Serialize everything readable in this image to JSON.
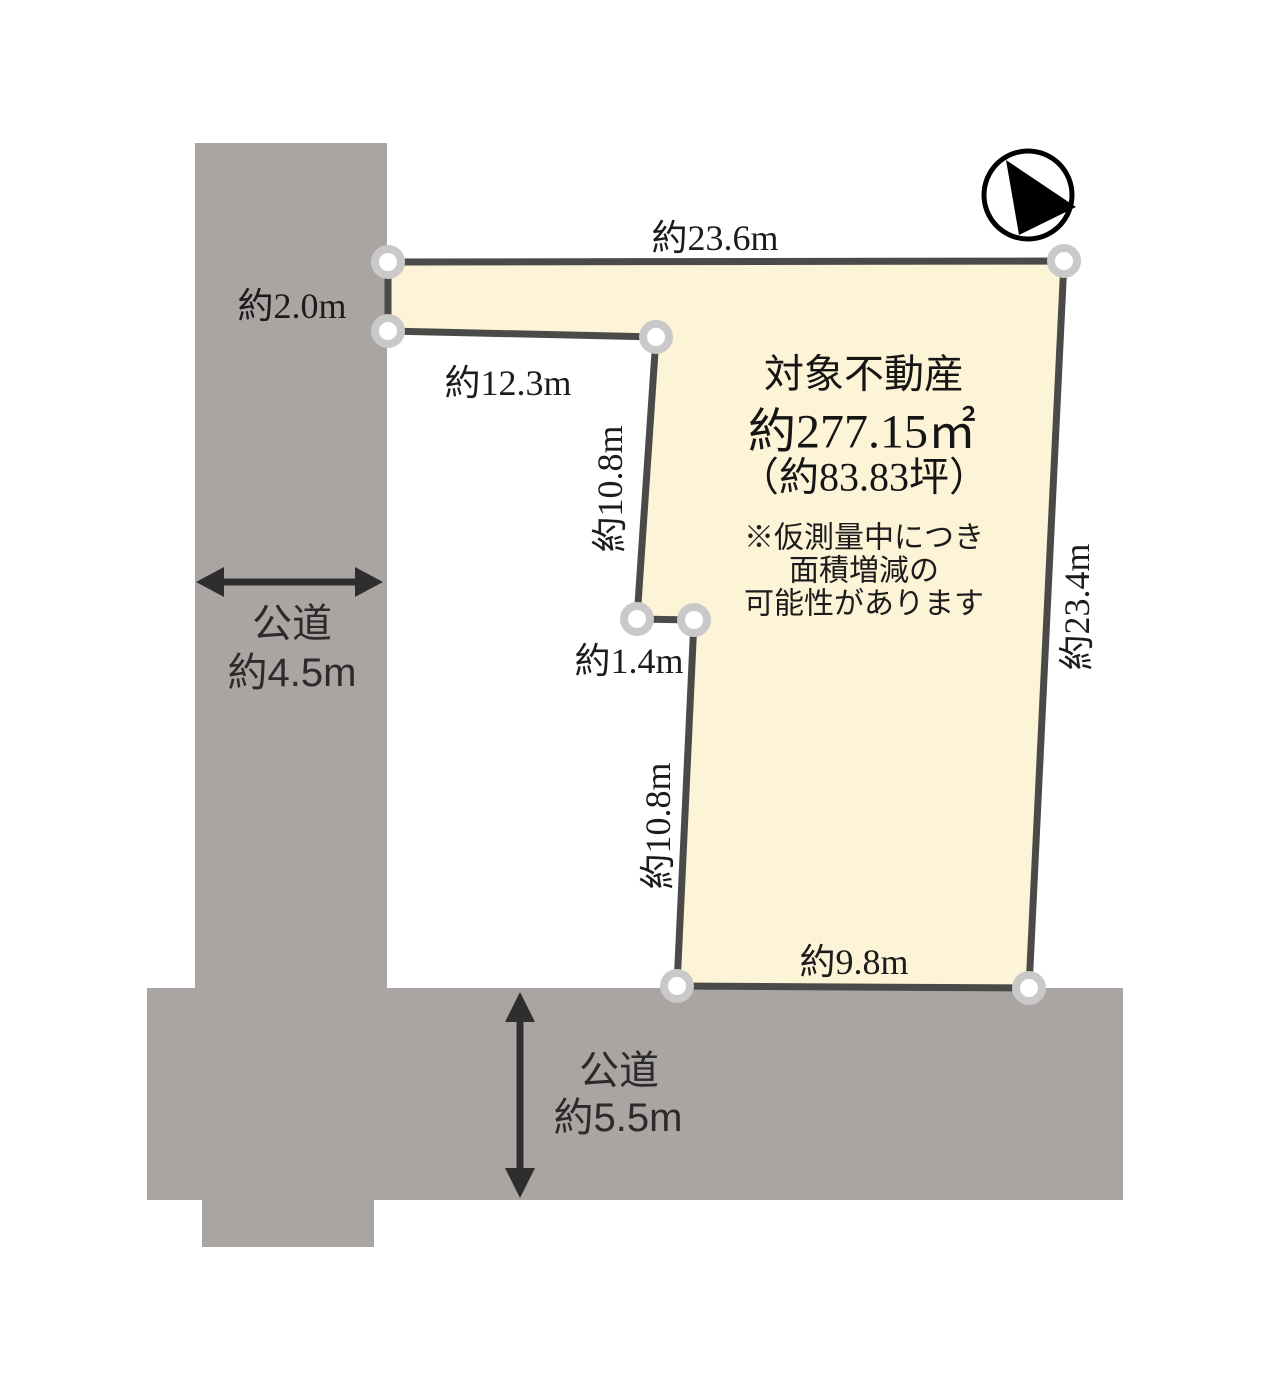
{
  "diagram": {
    "compass": {
      "icon": "north-arrow"
    },
    "parcel": {
      "title": "対象不動産",
      "area_m2": "約277.15㎡",
      "area_tsubo": "（約83.83坪）",
      "note_line1": "※仮測量中につき",
      "note_line2": "面積増減の",
      "note_line3": "可能性があります",
      "dimensions": {
        "top": "約23.6m",
        "left_upper": "約2.0m",
        "upper_horizontal": "約12.3m",
        "mid_vertical_upper": "約10.8m",
        "jog": "約1.4m",
        "mid_vertical_lower": "約10.8m",
        "right": "約23.4m",
        "bottom": "約9.8m"
      }
    },
    "roads": {
      "left": {
        "name": "公道",
        "width": "約4.5m"
      },
      "bottom": {
        "name": "公道",
        "width": "約5.5m"
      }
    },
    "colors": {
      "parcel_fill": "#fdf3d6",
      "parcel_border": "#4a4a48",
      "road_fill": "#aaa5a2",
      "vertex_ring": "#c9c9c9",
      "arrow": "#2e2e2e"
    }
  }
}
